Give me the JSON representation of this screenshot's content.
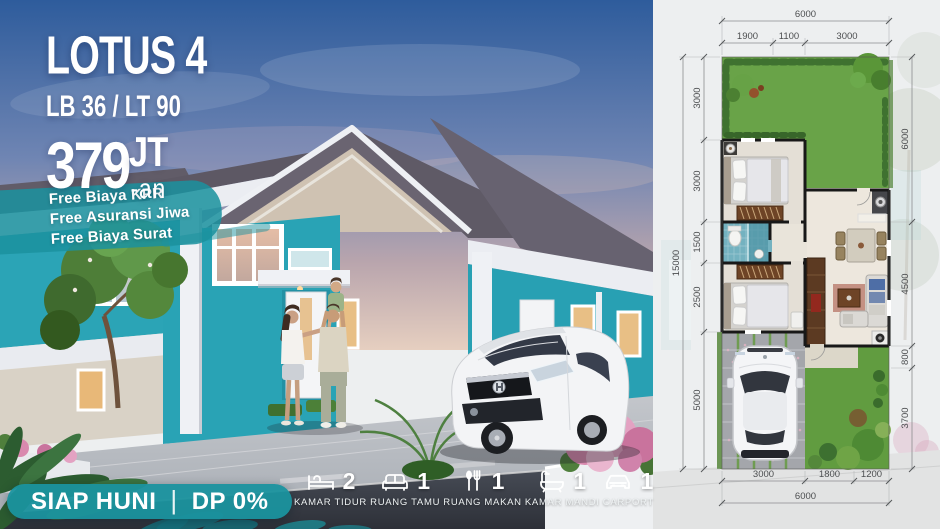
{
  "promo": {
    "title": "LOTUS 4",
    "spec": "LB 36 / LT 90",
    "price": {
      "number": "379",
      "unit": "JT",
      "suffix": "-an"
    },
    "perks": [
      "Free Biaya KPR",
      "Free Asuransi Jiwa",
      "Free Biaya Surat"
    ],
    "badge": {
      "left": "SIAP HUNI",
      "separator": "|",
      "right": "DP 0%"
    }
  },
  "features": [
    {
      "icon": "bed-icon",
      "count": "2",
      "label": "KAMAR TIDUR"
    },
    {
      "icon": "sofa-icon",
      "count": "1",
      "label": "RUANG TAMU"
    },
    {
      "icon": "cutlery-icon",
      "count": "1",
      "label": "RUANG MAKAN"
    },
    {
      "icon": "bathtub-icon",
      "count": "1",
      "label": "KAMAR MANDI"
    },
    {
      "icon": "car-icon",
      "count": "1",
      "label": "CARPORT"
    }
  ],
  "floor_plan": {
    "top": {
      "total": "6000",
      "segments": [
        "1900",
        "1100",
        "3000"
      ]
    },
    "left": {
      "total": "15000",
      "segments": [
        "3000",
        "3000",
        "1500",
        "2500",
        "5000"
      ]
    },
    "right": {
      "segments": [
        "6000",
        "4500",
        "800",
        "3700"
      ]
    },
    "bottom": {
      "total": "6000",
      "segments": [
        "3000",
        "1800",
        "1200"
      ]
    }
  },
  "colors": {
    "accent_teal": "#1b929e",
    "wall_teal": "#29a3b5",
    "roof_gray": "#5e5964",
    "grass_green": "#69a348",
    "bath_blue": "#74b2c0"
  }
}
